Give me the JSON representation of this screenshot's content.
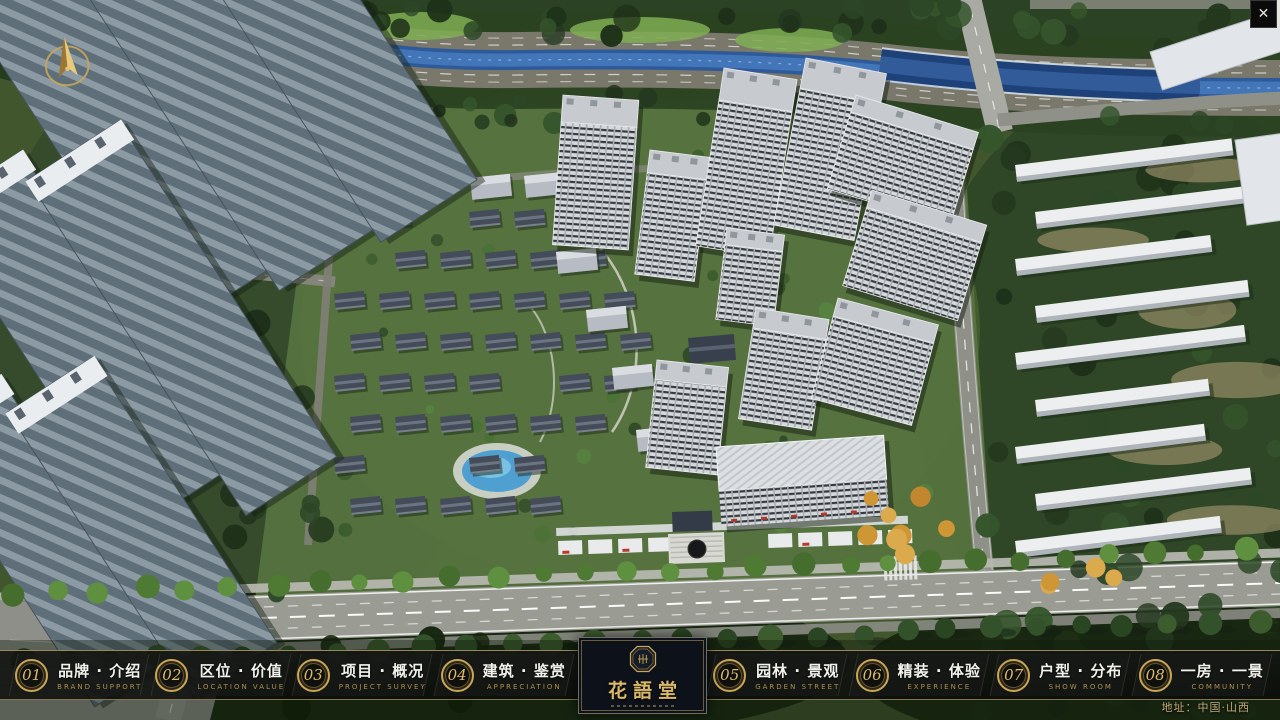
{
  "chrome": {
    "close_icon": "✕"
  },
  "nav": {
    "items": [
      {
        "num": "01",
        "title": "品牌 · 介绍",
        "subtitle": "BRAND SUPPORT"
      },
      {
        "num": "02",
        "title": "区位 · 价值",
        "subtitle": "LOCATION VALUE"
      },
      {
        "num": "03",
        "title": "项目 · 概况",
        "subtitle": "PROJECT SURVEY"
      },
      {
        "num": "04",
        "title": "建筑 · 鉴赏",
        "subtitle": "APPRECIATION"
      },
      {
        "num": "05",
        "title": "园林 · 景观",
        "subtitle": "GARDEN STREET"
      },
      {
        "num": "06",
        "title": "精装 · 体验",
        "subtitle": "EXPERIENCE"
      },
      {
        "num": "07",
        "title": "户型 · 分布",
        "subtitle": "SHOW ROOM"
      },
      {
        "num": "08",
        "title": "一房 · 一景",
        "subtitle": "COMMUNITY"
      }
    ]
  },
  "logo": {
    "title": "花語堂"
  },
  "footer": {
    "address": "地址：中国·山西"
  },
  "colors": {
    "gold_accent": "#c9a659",
    "bar_background": "#0c0e0c",
    "bar_border": "#a08f61",
    "logo_background": "#0d1119",
    "nav_title": "#f1f2ec",
    "nav_subtitle": "#ac904f",
    "address_text": "#d2b984",
    "river": "#2f5a9a",
    "lawn": "#587440"
  }
}
